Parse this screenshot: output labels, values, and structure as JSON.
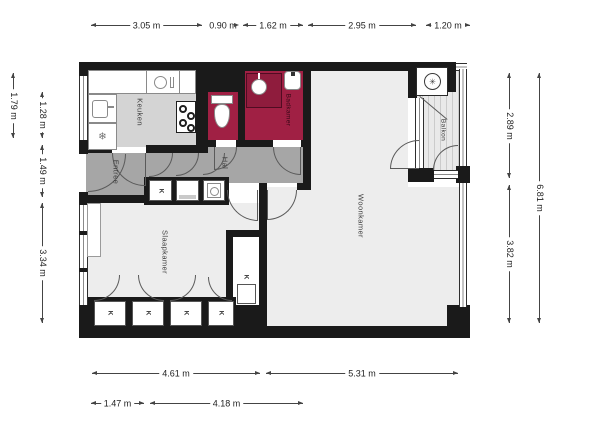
{
  "rooms": {
    "keuken": "Keuken",
    "badkamer": "Badkamer",
    "hal": "Hal",
    "entree": "Entree",
    "woonkamer": "Woonkamer",
    "slaapkamer": "Slaapkamer",
    "balkon": "Balkon"
  },
  "closet": {
    "label": "K"
  },
  "icons": {
    "fridge": "❄",
    "ventilation": "✳"
  },
  "dimensions": {
    "top": [
      "3.05 m",
      "0.90 m",
      "1.62 m",
      "2.95 m",
      "1.20 m"
    ],
    "left_outer": [
      "1.79 m"
    ],
    "left_inner": [
      "1.28 m",
      "1.49 m",
      "3.34 m"
    ],
    "right_inner": [
      "2.89 m",
      "3.82 m"
    ],
    "right_outer": [
      "6.81 m"
    ],
    "bottom_main": [
      "4.61 m",
      "5.31 m"
    ],
    "bottom_sub": [
      "1.47 m",
      "4.18 m"
    ]
  },
  "colors": {
    "wall": "#1a1a1a",
    "wet_room": "#a02044",
    "circulation": "#a6a6a6",
    "kitchen_floor": "#d4d4d4",
    "room_floor": "#ededed",
    "balcony_floor": "#e9e9e9",
    "fixture_border": "#8a8a8a",
    "dim_line": "#444444"
  }
}
